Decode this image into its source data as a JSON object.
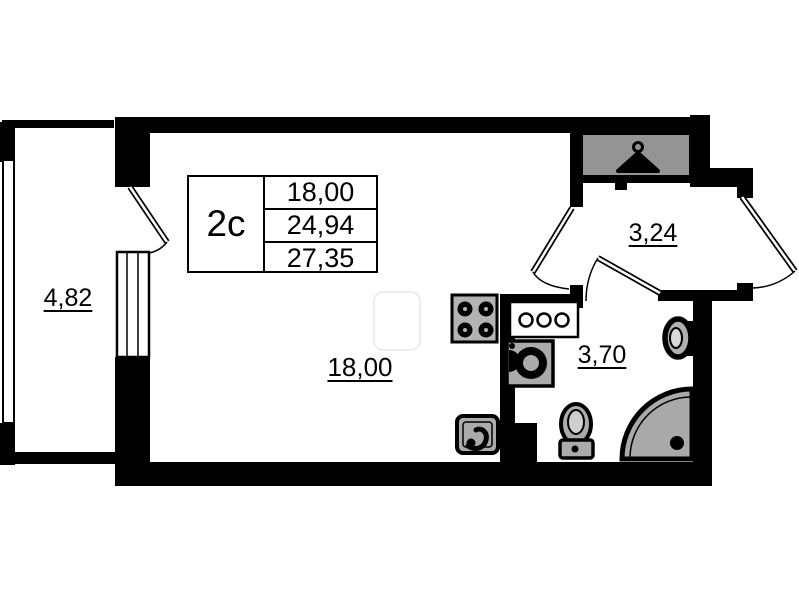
{
  "plan": {
    "unit_table": {
      "type_label": "2c",
      "rows": [
        "18,00",
        "24,94",
        "27,35"
      ]
    },
    "rooms": {
      "balcony": {
        "area": "4,82"
      },
      "living": {
        "area": "18,00"
      },
      "hallway": {
        "area": "3,24"
      },
      "bathroom": {
        "area": "3,70"
      }
    },
    "colors": {
      "wall": "#000000",
      "background": "#ffffff",
      "fixture_gray": "#ababab",
      "wardrobe_gray": "#949494",
      "shower_gray": "#a9a9a9"
    },
    "icons": {
      "wardrobe": "hanger-icon",
      "kitchen_stove": "stove-icon",
      "kitchen_sink": "kitchen-sink-icon",
      "washbasin_counter": "washbasin-counter-icon",
      "washing_machine": "washing-machine-icon",
      "wall_sink": "wall-sink-icon",
      "toilet": "toilet-icon",
      "shower": "shower-icon"
    }
  }
}
